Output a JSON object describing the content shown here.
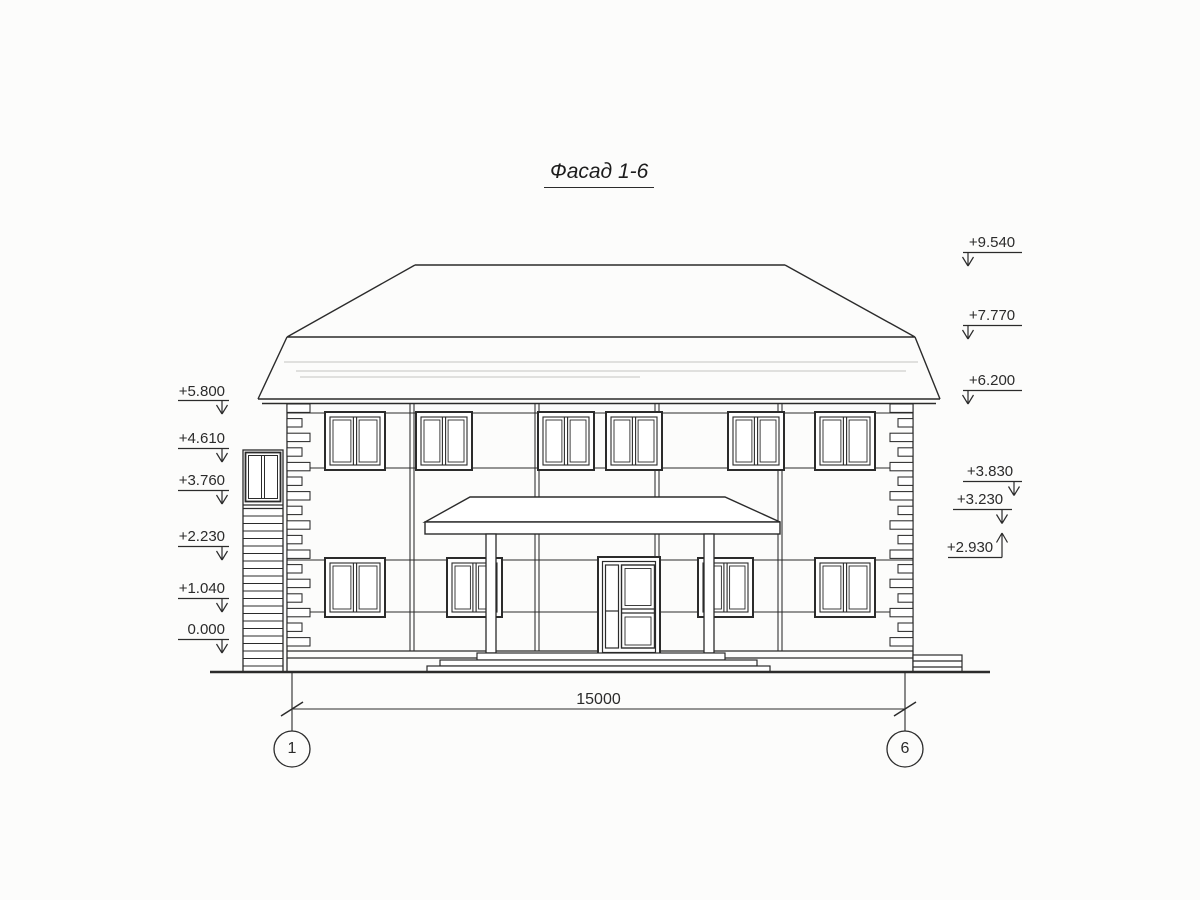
{
  "title": "Фасад 1-6",
  "elevation_marks_left": [
    "+5.800",
    "+4.610",
    "+3.760",
    "+2.230",
    "+1.040",
    "0.000"
  ],
  "elevation_marks_right_top": [
    "+9.540",
    "+7.770",
    "+6.200"
  ],
  "elevation_marks_right_bottom": [
    "+3.830",
    "+3.230",
    "+2.930"
  ],
  "dimension_total": "15000",
  "axis_left": "1",
  "axis_right": "6",
  "colors": {
    "line": "#2b2b2b",
    "paper": "#fcfcfb"
  }
}
